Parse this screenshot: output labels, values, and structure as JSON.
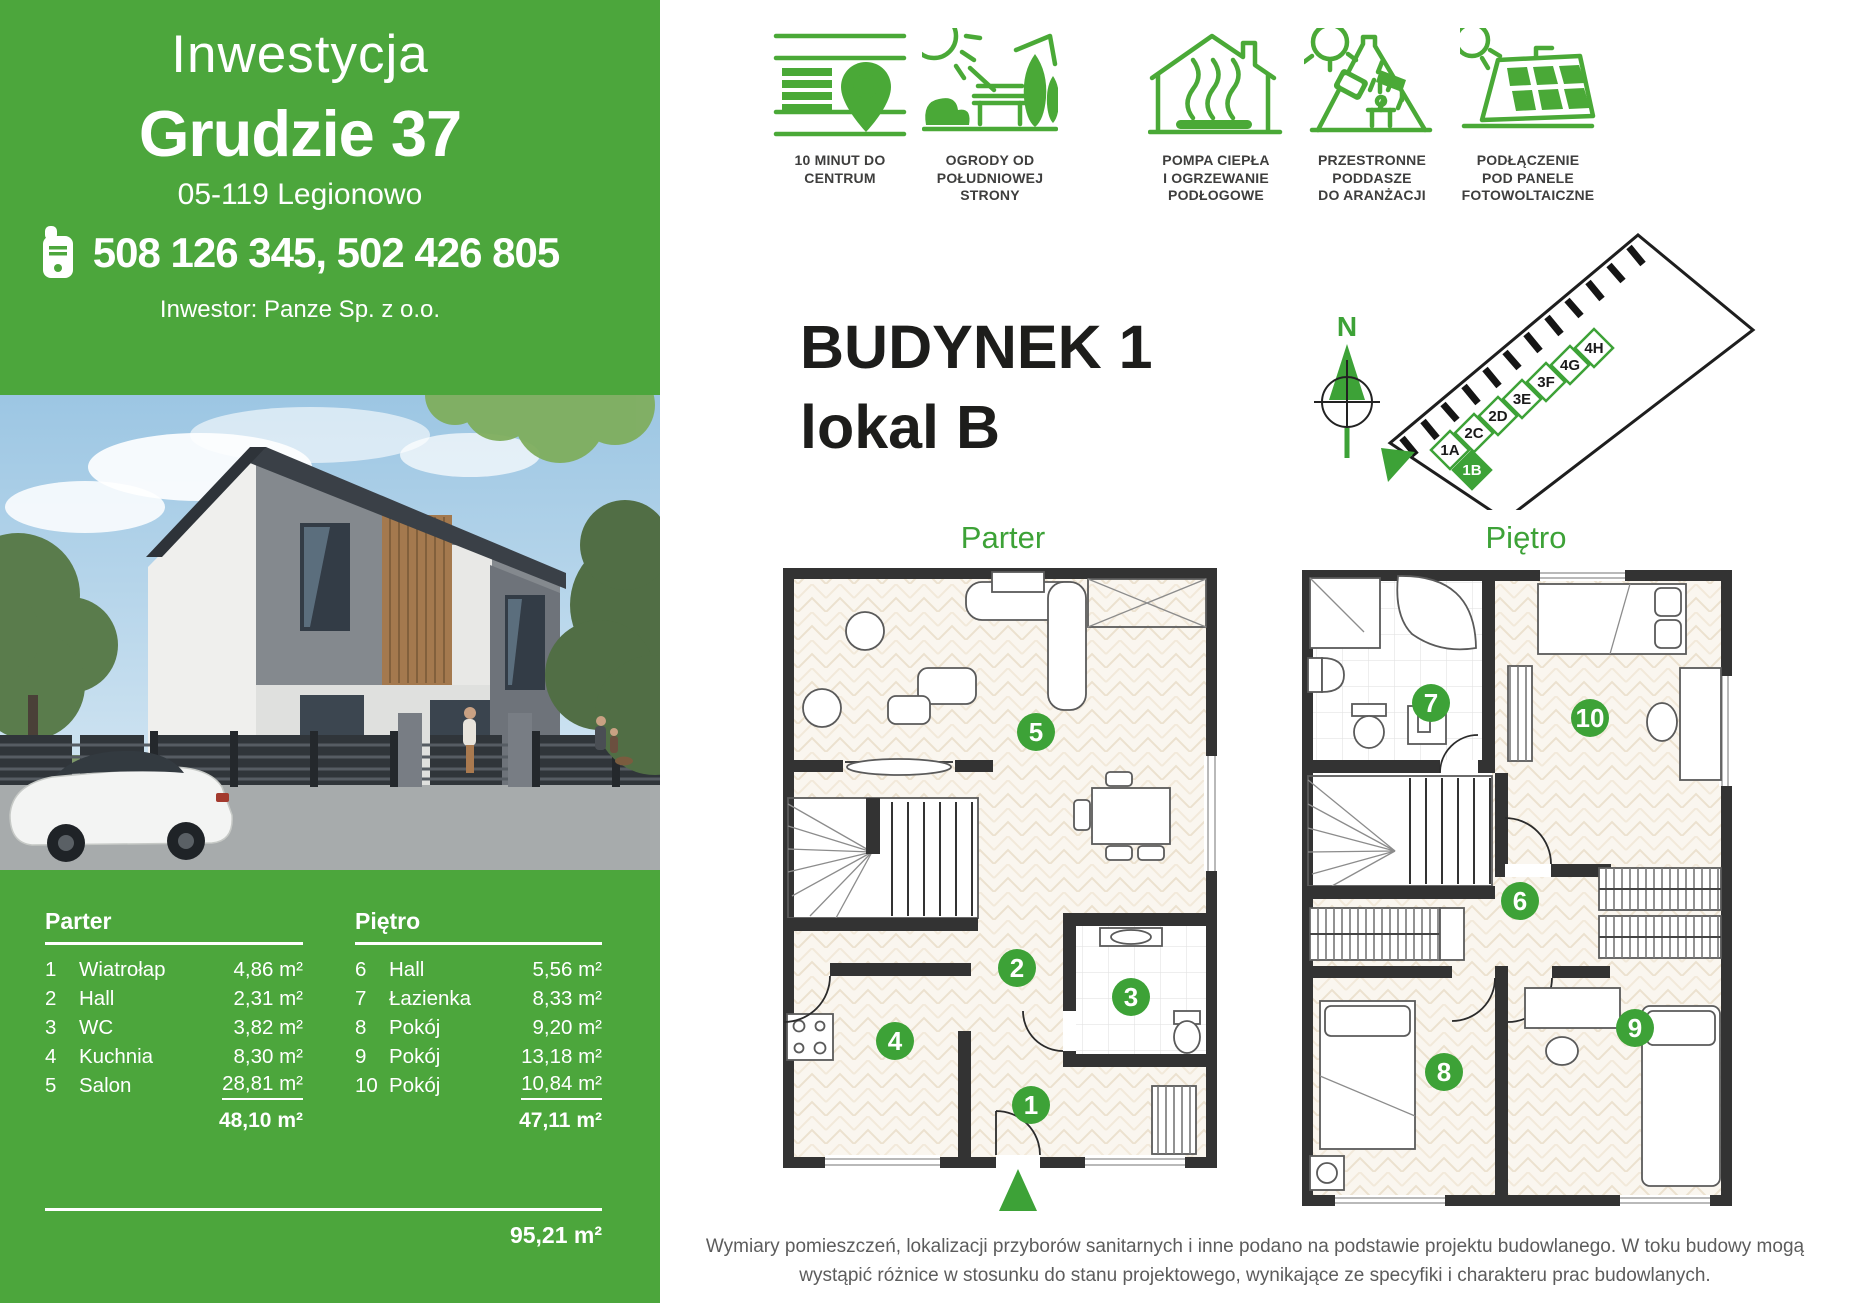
{
  "sidebar": {
    "title_light": "Inwestycja",
    "title_bold": "Grudzie 37",
    "address": "05-119 Legionowo",
    "phone_numbers": "508 126 345, 502 426 805",
    "investor": "Inwestor: Panze Sp. z o.o.",
    "area_table": {
      "left": {
        "header": "Parter",
        "rows": [
          {
            "no": "1",
            "name": "Wiatrołap",
            "area": "4,86 m²"
          },
          {
            "no": "2",
            "name": "Hall",
            "area": "2,31 m²"
          },
          {
            "no": "3",
            "name": "WC",
            "area": "3,82 m²"
          },
          {
            "no": "4",
            "name": "Kuchnia",
            "area": "8,30 m²"
          },
          {
            "no": "5",
            "name": "Salon",
            "area": "28,81 m²"
          }
        ],
        "total": "48,10 m²"
      },
      "right": {
        "header": "Piętro",
        "rows": [
          {
            "no": "6",
            "name": "Hall",
            "area": "5,56 m²"
          },
          {
            "no": "7",
            "name": "Łazienka",
            "area": "8,33 m²"
          },
          {
            "no": "8",
            "name": "Pokój",
            "area": "9,20 m²"
          },
          {
            "no": "9",
            "name": "Pokój",
            "area": "13,18 m²"
          },
          {
            "no": "10",
            "name": "Pokój",
            "area": "10,84 m²"
          }
        ],
        "total": "47,11 m²"
      },
      "grand_total": "95,21 m²"
    }
  },
  "features": [
    {
      "icon": "map-pin-icon",
      "lines": [
        "10 MINUT  DO",
        "CENTRUM"
      ]
    },
    {
      "icon": "garden-icon",
      "lines": [
        "OGRODY OD",
        "POŁUDNIOWEJ",
        "STRONY"
      ]
    },
    {
      "icon": "heat-pump-icon",
      "lines": [
        "POMPA CIEPŁA",
        "I OGRZEWANIE",
        "PODŁOGOWE"
      ]
    },
    {
      "icon": "attic-icon",
      "lines": [
        "PRZESTRONNE",
        "PODDASZE",
        "DO ARANŻACJI"
      ]
    },
    {
      "icon": "solar-panel-icon",
      "lines": [
        "PODŁĄCZENIE",
        "POD PANELE",
        "FOTOWOLTAICZNE"
      ]
    }
  ],
  "main": {
    "building_title": "BUDYNEK 1",
    "unit_title": "lokal B",
    "compass_label": "N",
    "site_units": [
      {
        "id": "1A",
        "highlight": false
      },
      {
        "id": "1B",
        "highlight": true
      },
      {
        "id": "2C",
        "highlight": false
      },
      {
        "id": "2D",
        "highlight": false
      },
      {
        "id": "3E",
        "highlight": false
      },
      {
        "id": "3F",
        "highlight": false
      },
      {
        "id": "4G",
        "highlight": false
      },
      {
        "id": "4H",
        "highlight": false
      }
    ],
    "floor_labels": {
      "ground": "Parter",
      "upper": "Piętro"
    },
    "rooms": [
      "1",
      "2",
      "3",
      "4",
      "5",
      "6",
      "7",
      "8",
      "9",
      "10"
    ]
  },
  "footer": {
    "line1": "Wymiary pomieszczeń, lokalizacji przyborów sanitarnych i inne podano na podstawie projektu budowlanego.  W toku budowy mogą",
    "line2": "wystąpić różnice w stosunku do stanu projektowego, wynikające ze specyfiki i charakteru prac budowlanych."
  },
  "colors": {
    "brand_green": "#4ca63c",
    "icon_green": "#4aa937",
    "accent_green": "#3da237",
    "wall_dark": "#333333"
  }
}
